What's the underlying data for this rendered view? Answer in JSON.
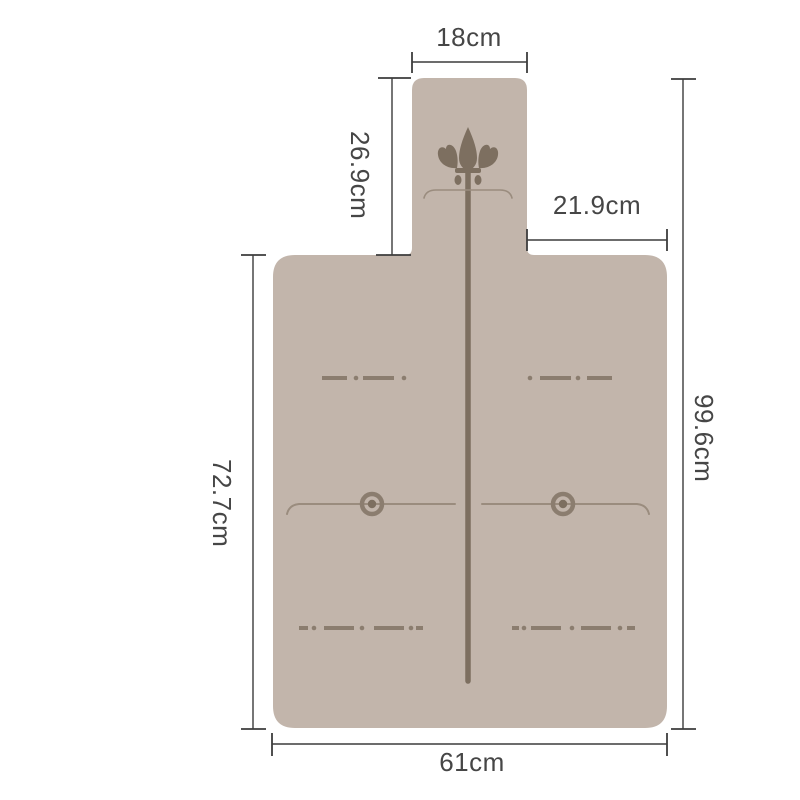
{
  "diagram": {
    "kind": "product-dimension-diagram",
    "labels": {
      "top_width": "18cm",
      "neck_height": "26.9cm",
      "shoulder_width": "21.9cm",
      "overall_height": "99.6cm",
      "body_height": "72.7cm",
      "bottom_width": "61cm"
    },
    "icons": [
      "fleur-de-lis-icon",
      "grommet-ring-icon"
    ],
    "colors": {
      "background": "#ffffff",
      "mat_fill": "#c2b5ab",
      "ornament": "#8b7d6f",
      "ornament_dark": "#7d6f60",
      "thin_line": "#9a8c7e",
      "dimension_line": "#3c3c3c",
      "label_text": "#464646"
    }
  }
}
